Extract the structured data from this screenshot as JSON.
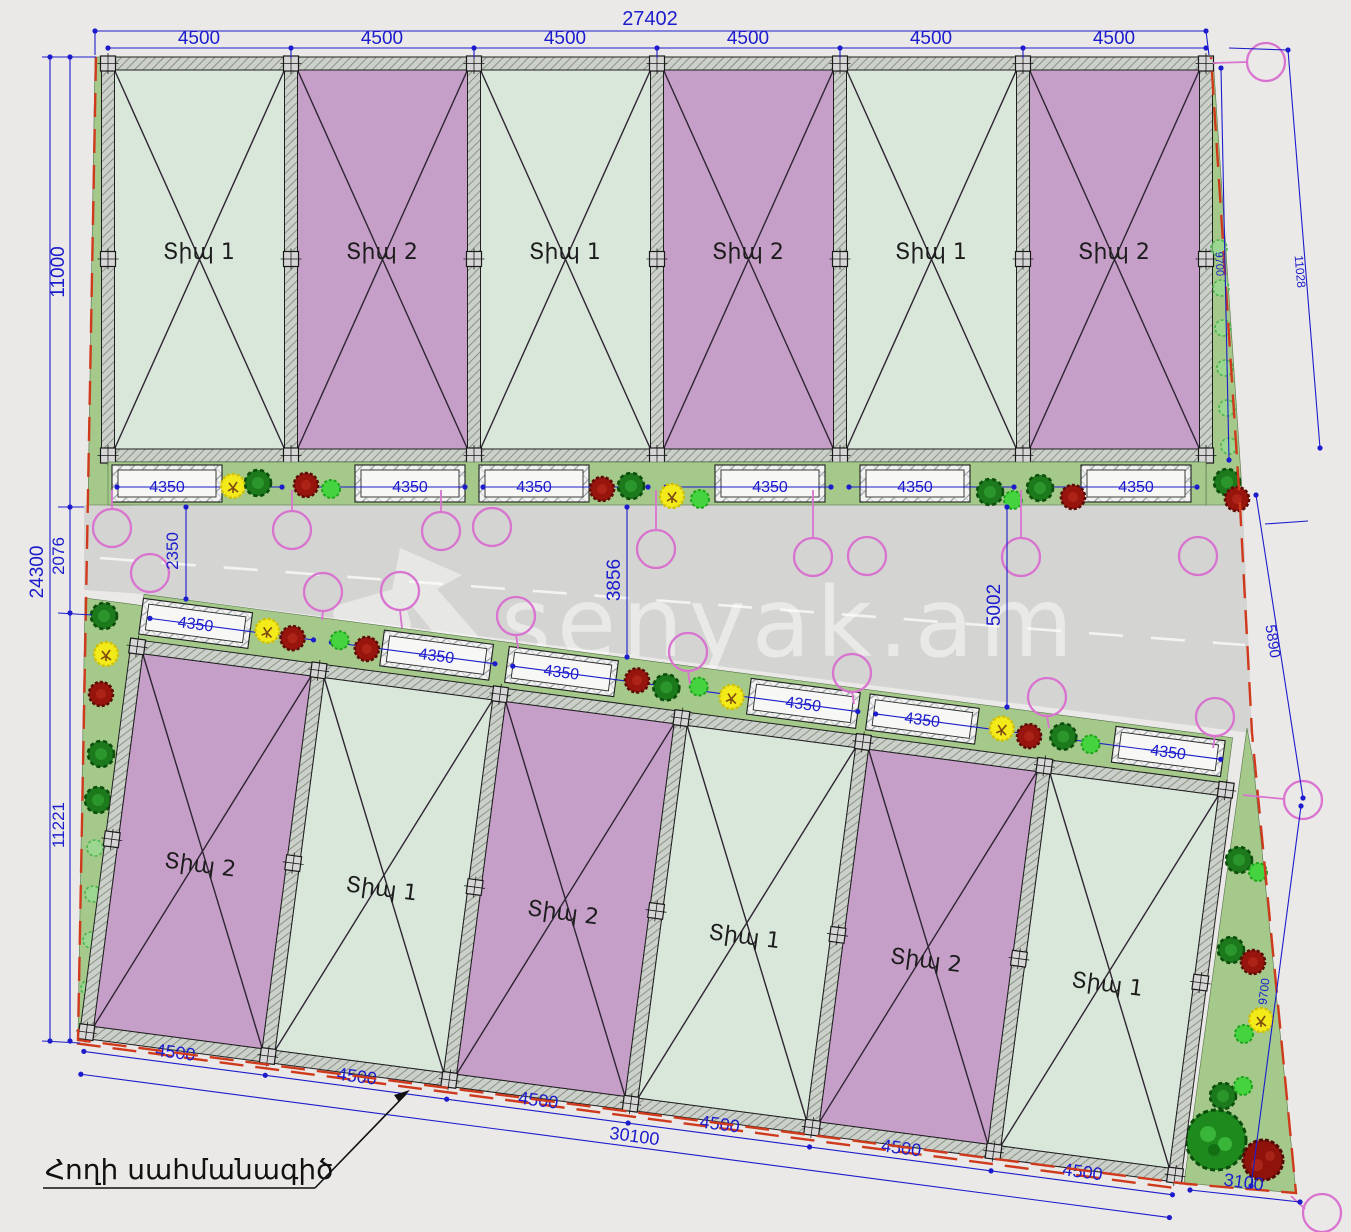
{
  "watermark": "senyak.am",
  "labels": {
    "boundary": "Հողի սահմանագիծ"
  },
  "plots": {
    "top": [
      "Տիպ 1",
      "Տիպ 2",
      "Տիպ 1",
      "Տիպ 2",
      "Տիպ 1",
      "Տիպ 2"
    ],
    "bottom": [
      "Տիպ 2",
      "Տիպ 1",
      "Տիպ 2",
      "Տիպ 1",
      "Տիպ 2",
      "Տիպ 1"
    ]
  },
  "dims": {
    "top_total": "27402",
    "top_segments": [
      "4500",
      "4500",
      "4500",
      "4500",
      "4500",
      "4500"
    ],
    "left_total": "24300",
    "left_top": "11000",
    "left_mid": "2076",
    "left_bottom": "11221",
    "road_left": "2350",
    "road_mid": "3856",
    "road_right": "5002",
    "right_top": "9700",
    "right_outer": "11028",
    "right_mid": "5890",
    "right_bottom": "9700",
    "bottom_segments": [
      "4500",
      "4500",
      "4500",
      "4500",
      "4500",
      "4500"
    ],
    "bottom_total": "30100",
    "bottom_right": "3100",
    "parking_top": [
      "4350",
      "4350",
      "4350",
      "4350",
      "4350",
      "4350"
    ],
    "parking_bottom": [
      "4350",
      "4350",
      "4350",
      "4350",
      "4350",
      "4350"
    ]
  },
  "colors": {
    "type1_fill": "#d9e7da",
    "type2_fill": "#c69fc8",
    "dimension_blue": "#1c1ccd",
    "boundary_red": "#cf3a1d",
    "road_gray": "#d4d4d2",
    "green_area": "#a5c98b",
    "tree_pink": "#d873cf"
  }
}
